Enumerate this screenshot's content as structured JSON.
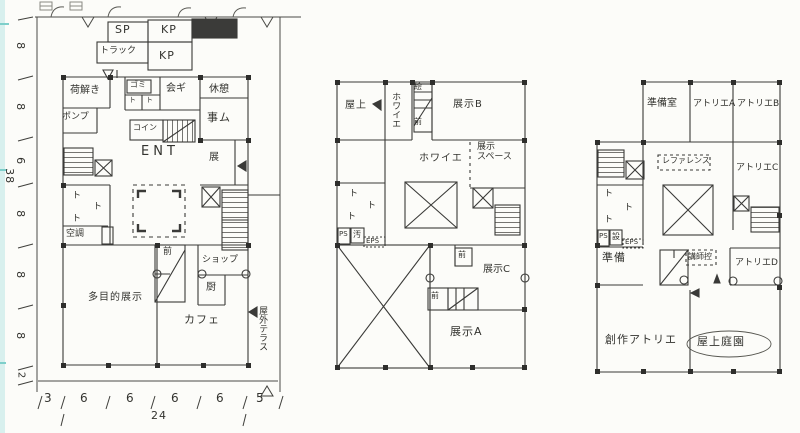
{
  "palette": {
    "ink": "#3a3a38",
    "paper": "#fcfcf9",
    "scan_edge": "#7ecfca",
    "dark_block": "#3b3b39"
  },
  "marks": {
    "toilet": "ト"
  },
  "dims": {
    "left": [
      "8",
      "8",
      "6",
      "8",
      "8",
      "8",
      "2"
    ],
    "left_total": "38",
    "bottom": [
      "3",
      "6",
      "6",
      "6",
      "6",
      "5"
    ],
    "bottom_total": "24"
  },
  "plan1": {
    "sp": "SP",
    "kp1": "KP",
    "kp2": "KP",
    "truck": "トラック",
    "unloading": "荷解き",
    "trash": "ゴミ",
    "meeting": "会ギ",
    "rest": "休憩",
    "office": "事ム",
    "pump": "ポンプ",
    "coin": "コイン",
    "entrance": "ENT",
    "exhibit": "展",
    "hvac": "空調",
    "anteroom": "前",
    "shop": "ショップ",
    "kitchen": "厨",
    "cafe": "カフェ",
    "multipurpose": "多目的展示",
    "terrace": "屋外テラス"
  },
  "plan2": {
    "roof": "屋上",
    "foyer_vertical": "ホワイエ",
    "art_storage": "絵",
    "anteroom_upper": "前",
    "exhibit_b": "展示B",
    "foyer": "ホワイエ",
    "exhibit_space": "展示\nスペース",
    "ps": "PS",
    "slop": "汚",
    "eps": "EPS",
    "anteroom_c": "前",
    "exhibit_c": "展示C",
    "anteroom_a": "前",
    "exhibit_a": "展示A"
  },
  "plan3": {
    "prep_room": "準備室",
    "atelier_a": "アトリエA",
    "atelier_b": "アトリエB",
    "reference": "レファレンス",
    "atelier_c": "アトリエC",
    "ps": "PS",
    "equip": "設",
    "eps": "EPS",
    "prep": "準備",
    "lecturer": "講師控",
    "atelier_d": "アトリエD",
    "creative_atelier": "創作アトリエ",
    "roof_garden": "屋上庭園"
  }
}
